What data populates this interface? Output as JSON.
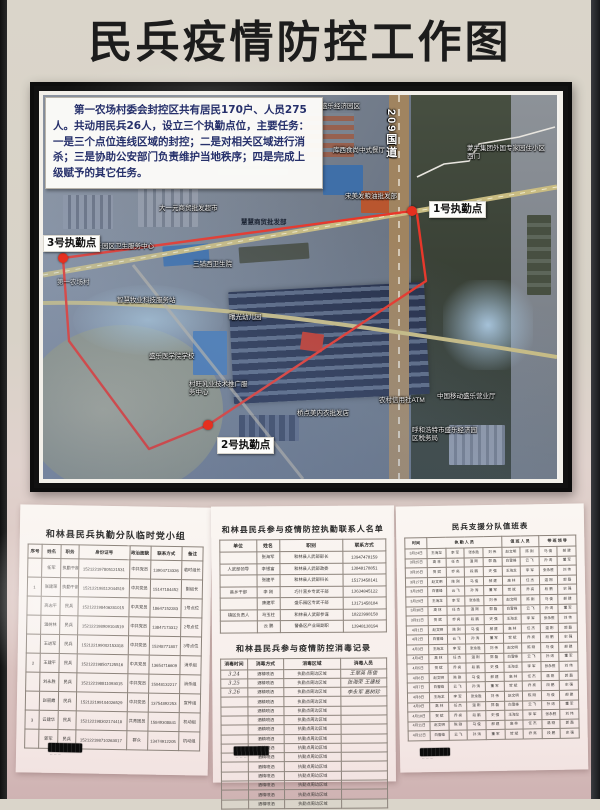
{
  "title": "民兵疫情防控工作图",
  "map": {
    "info_box": "第一农场村委会封控区共有居民170户、人员275人。共动用民兵26人，设立三个执勤点位，主要任务：一是三个点位连线区域的封控；二是对相关区域进行消杀；三是协助公安部门负责维护当地秩序；四是完成上级赋予的其它任务。",
    "route_points": "369,116 20,163 26,246 106,354 165,330 383,186 374,119 369,116",
    "road_label": "209国道",
    "duty_points": [
      {
        "label": "1号执勤点",
        "dot": [
          369,
          116
        ],
        "pos": [
          386,
          106
        ]
      },
      {
        "label": "2号执勤点",
        "dot": [
          165,
          330
        ],
        "pos": [
          174,
          342
        ]
      },
      {
        "label": "3号执勤点",
        "dot": [
          20,
          163
        ],
        "pos": [
          0,
          140
        ]
      }
    ],
    "labels": [
      {
        "t": "盛乐经济园区",
        "x": 278,
        "y": 8
      },
      {
        "t": "库西食尚中式餐厅",
        "x": 290,
        "y": 52,
        "w": 58
      },
      {
        "t": "蒙牛集团外国专家园住小区西门",
        "x": 424,
        "y": 50,
        "w": 80
      },
      {
        "t": "宋美发粮油批发部",
        "x": 302,
        "y": 98,
        "w": 54
      },
      {
        "t": "大一元商贸批发超市",
        "x": 116,
        "y": 110,
        "w": 66
      },
      {
        "t": "慧慧商贸批发部",
        "x": 198,
        "y": 124,
        "cls": "dark"
      },
      {
        "t": "盛乐园区卫生服务中心",
        "x": 46,
        "y": 148,
        "w": 66
      },
      {
        "t": "三铺西卫生院",
        "x": 150,
        "y": 166
      },
      {
        "t": "第一农场村",
        "x": 14,
        "y": 184,
        "cls": "faint"
      },
      {
        "t": "智慧牧业科技服务站",
        "x": 74,
        "y": 202,
        "w": 60
      },
      {
        "t": "曙光幼儿园",
        "x": 186,
        "y": 219
      },
      {
        "t": "盛乐医学院学校",
        "x": 106,
        "y": 258,
        "w": 56
      },
      {
        "t": "村旺乳业技术推广服务中心",
        "x": 146,
        "y": 286,
        "w": 64
      },
      {
        "t": "桥点美内衣批发店",
        "x": 254,
        "y": 315
      },
      {
        "t": "农村信用社ATM",
        "x": 336,
        "y": 302,
        "w": 46
      },
      {
        "t": "中国移动盛乐营业厅",
        "x": 394,
        "y": 298,
        "w": 60
      },
      {
        "t": "呼和浩特市盛乐经济园区税务局",
        "x": 369,
        "y": 332,
        "w": 70
      }
    ]
  },
  "documents": {
    "left": {
      "title": "和林县民兵执勤分队临时党小组",
      "table": {
        "headers": [
          "序号",
          "姓名",
          "职务",
          "身份证号",
          "政治面貌",
          "联系方式",
          "备注"
        ],
        "rows": [
          [
            "",
            "任军",
            "执勤干部",
            "152122197805121531",
            "中共党员",
            "13904713326",
            "临时组长"
          ],
          [
            "1",
            "张建荣",
            "执勤干部",
            "152122198112044519",
            "中共党员",
            "15147184452",
            "副组长"
          ],
          [
            "",
            "高志平",
            "民兵",
            "152122198406281015",
            "中共党员",
            "18647152283",
            "1号点位"
          ],
          [
            "",
            "温树林",
            "民兵",
            "152122198909104519",
            "中共党员",
            "13847173312",
            "2号点位"
          ],
          [
            "",
            "王进军",
            "民兵",
            "152122199002153318",
            "中共党员",
            "15248771807",
            "3号点位"
          ],
          [
            "2",
            "王建平",
            "民兵",
            "152122198507125516",
            "中共党员",
            "13654716609",
            "消杀组"
          ],
          [
            "",
            "刘永胜",
            "民兵",
            "152122198811093015",
            "中共党员",
            "15048132217",
            "消杀组"
          ],
          [
            "",
            "赵丽霞",
            "民兵",
            "152122199104026529",
            "中共党员",
            "13754892253",
            "宣传组"
          ],
          [
            "3",
            "云建华",
            "民兵",
            "152122198302174418",
            "共青团员",
            "15849308841",
            "机动组"
          ],
          [
            "",
            "郭军",
            "民兵",
            "152122198710263017",
            "群众",
            "13474912205",
            "机动组"
          ]
        ]
      }
    },
    "middle_top": {
      "title": "和林县民兵参与疫情防控执勤联系人名单",
      "table": {
        "headers": [
          "单位",
          "姓名",
          "职别",
          "联系方式"
        ],
        "rows": [
          [
            "",
            "张海军",
            "和林县人武部部长",
            "13947478159"
          ],
          [
            "人武部领导",
            "李银富",
            "和林县人武部政委",
            "13848178851"
          ],
          [
            "",
            "张建平",
            "和林县人武部科长",
            "15173458141"
          ],
          [
            "县乡干部",
            "李 刚",
            "巧什营乡专武干部",
            "13634845122"
          ],
          [
            "",
            "康建军",
            "盛乐园区专武干部",
            "13171458184"
          ],
          [
            "镇区负责人",
            "马玉柱",
            "和林县人武部参谋",
            "18223998158"
          ],
          [
            "",
            "云 鹏",
            "警备区产业局副职",
            "13948138194"
          ]
        ]
      }
    },
    "middle_bottom": {
      "title": "和林县民兵参与疫情防控消毒记录",
      "table": {
        "headers": [
          "消毒时间",
          "消毒方式",
          "消毒区域",
          "消毒人员"
        ],
        "hand_cols": [
          0,
          3
        ],
        "rows": [
          [
            "3.24",
            "酒精喷洒",
            "执勤点周边区域",
            "王翠英 陈俊"
          ],
          [
            "3.25",
            "酒精喷洒",
            "执勤点周边区域",
            "张海荣 王建枝"
          ],
          [
            "3.26",
            "酒精喷洒",
            "执勤点周边区域",
            "李永军 高树珍"
          ],
          [
            "",
            "酒精喷洒",
            "执勤点周边区域",
            ""
          ],
          [
            "",
            "酒精喷洒",
            "执勤点周边区域",
            ""
          ],
          [
            "",
            "酒精喷洒",
            "执勤点周边区域",
            ""
          ],
          [
            "",
            "酒精喷洒",
            "执勤点周边区域",
            ""
          ],
          [
            "",
            "酒精喷洒",
            "执勤点周边区域",
            ""
          ],
          [
            "",
            "酒精喷洒",
            "执勤点周边区域",
            ""
          ],
          [
            "",
            "酒精喷洒",
            "执勤点周边区域",
            ""
          ],
          [
            "",
            "酒精喷洒",
            "执勤点周边区域",
            ""
          ],
          [
            "",
            "酒精喷洒",
            "执勤点周边区域",
            ""
          ],
          [
            "",
            "酒精喷洒",
            "执勤点周边区域",
            ""
          ],
          [
            "",
            "酒精喷洒",
            "执勤点周边区域",
            ""
          ],
          [
            "",
            "酒精喷洒",
            "执勤点周边区域",
            ""
          ]
        ]
      }
    },
    "right": {
      "title": "民兵支援分队值班表",
      "table": {
        "header_groups": [
          {
            "label": "时间",
            "span": 1
          },
          {
            "label": "执 勤 人 员",
            "span": 4
          },
          {
            "label": "值 班 人 员",
            "span": 2
          },
          {
            "label": "带 班 领 导",
            "span": 2
          }
        ],
        "rows": [
          [
            "3月24日",
            "王海龙",
            "李 军",
            "张永胜",
            "刘 伟",
            "赵文明",
            "陈 刚",
            "马 俊",
            "郝 建"
          ],
          [
            "3月25日",
            "高 林",
            "任 杰",
            "温 刚",
            "郭 磊",
            "白雪峰",
            "云 飞",
            "孙 涛",
            "董 军"
          ],
          [
            "3月26日",
            "贺 斌",
            "乔 亮",
            "段 鹏",
            "史 强",
            "王海龙",
            "李 军",
            "张永胜",
            "刘 伟"
          ],
          [
            "3月27日",
            "赵文明",
            "陈 刚",
            "马 俊",
            "郝 建",
            "高 林",
            "任 杰",
            "温 刚",
            "郭 磊"
          ],
          [
            "3月28日",
            "白雪峰",
            "云 飞",
            "孙 涛",
            "董 军",
            "贺 斌",
            "乔 亮",
            "段 鹏",
            "史 强"
          ],
          [
            "3月29日",
            "王海龙",
            "李 军",
            "张永胜",
            "刘 伟",
            "赵文明",
            "陈 刚",
            "马 俊",
            "郝 建"
          ],
          [
            "3月30日",
            "高 林",
            "任 杰",
            "温 刚",
            "郭 磊",
            "白雪峰",
            "云 飞",
            "孙 涛",
            "董 军"
          ],
          [
            "3月31日",
            "贺 斌",
            "乔 亮",
            "段 鹏",
            "史 强",
            "王海龙",
            "李 军",
            "张永胜",
            "刘 伟"
          ],
          [
            "4月1日",
            "赵文明",
            "陈 刚",
            "马 俊",
            "郝 建",
            "高 林",
            "任 杰",
            "温 刚",
            "郭 磊"
          ],
          [
            "4月2日",
            "白雪峰",
            "云 飞",
            "孙 涛",
            "董 军",
            "贺 斌",
            "乔 亮",
            "段 鹏",
            "史 强"
          ],
          [
            "4月3日",
            "王海龙",
            "李 军",
            "张永胜",
            "刘 伟",
            "赵文明",
            "陈 刚",
            "马 俊",
            "郝 建"
          ],
          [
            "4月4日",
            "高 林",
            "任 杰",
            "温 刚",
            "郭 磊",
            "白雪峰",
            "云 飞",
            "孙 涛",
            "董 军"
          ],
          [
            "4月5日",
            "贺 斌",
            "乔 亮",
            "段 鹏",
            "史 强",
            "王海龙",
            "李 军",
            "张永胜",
            "刘 伟"
          ],
          [
            "4月6日",
            "赵文明",
            "陈 刚",
            "马 俊",
            "郝 建",
            "高 林",
            "任 杰",
            "温 刚",
            "郭 磊"
          ],
          [
            "4月7日",
            "白雪峰",
            "云 飞",
            "孙 涛",
            "董 军",
            "贺 斌",
            "乔 亮",
            "段 鹏",
            "史 强"
          ],
          [
            "4月8日",
            "王海龙",
            "李 军",
            "张永胜",
            "刘 伟",
            "赵文明",
            "陈 刚",
            "马 俊",
            "郝 建"
          ],
          [
            "4月9日",
            "高 林",
            "任 杰",
            "温 刚",
            "郭 磊",
            "白雪峰",
            "云 飞",
            "孙 涛",
            "董 军"
          ],
          [
            "4月10日",
            "贺 斌",
            "乔 亮",
            "段 鹏",
            "史 强",
            "王海龙",
            "李 军",
            "张永胜",
            "刘 伟"
          ],
          [
            "4月11日",
            "赵文明",
            "陈 刚",
            "马 俊",
            "郝 建",
            "高 林",
            "任 杰",
            "温 刚",
            "郭 磊"
          ],
          [
            "4月12日",
            "白雪峰",
            "云 飞",
            "孙 涛",
            "董 军",
            "贺 斌",
            "乔 亮",
            "段 鹏",
            "史 强"
          ]
        ]
      }
    }
  }
}
